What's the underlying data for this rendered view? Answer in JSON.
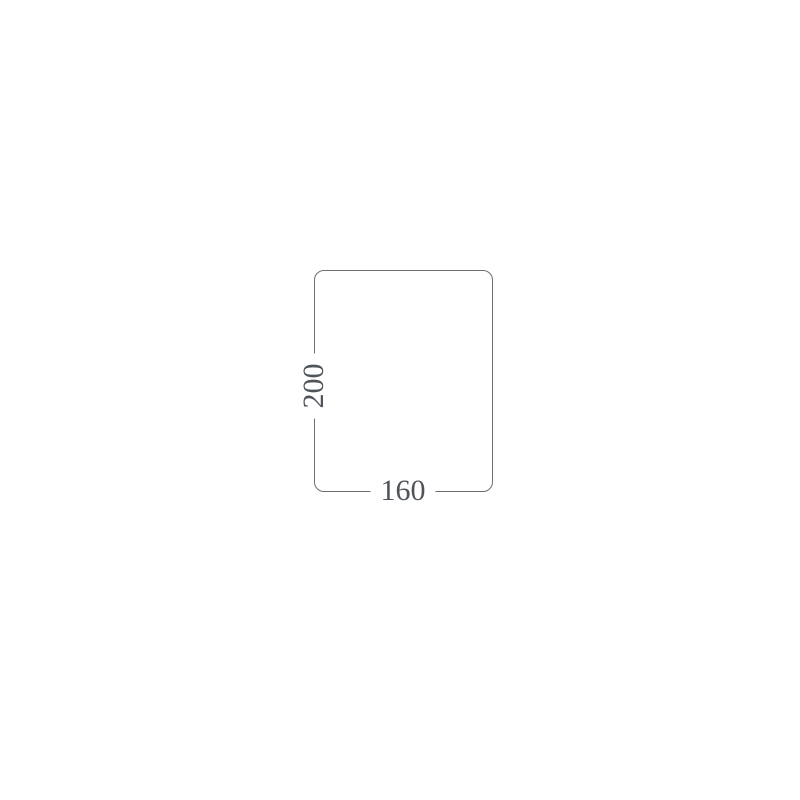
{
  "colors": {
    "background": "#ffffff",
    "line": "#6e6e6e",
    "text": "#4f545b"
  },
  "diagram": {
    "type": "dimension-outline",
    "shape": "rounded-rectangle",
    "height_label": "200",
    "width_label": "160"
  }
}
